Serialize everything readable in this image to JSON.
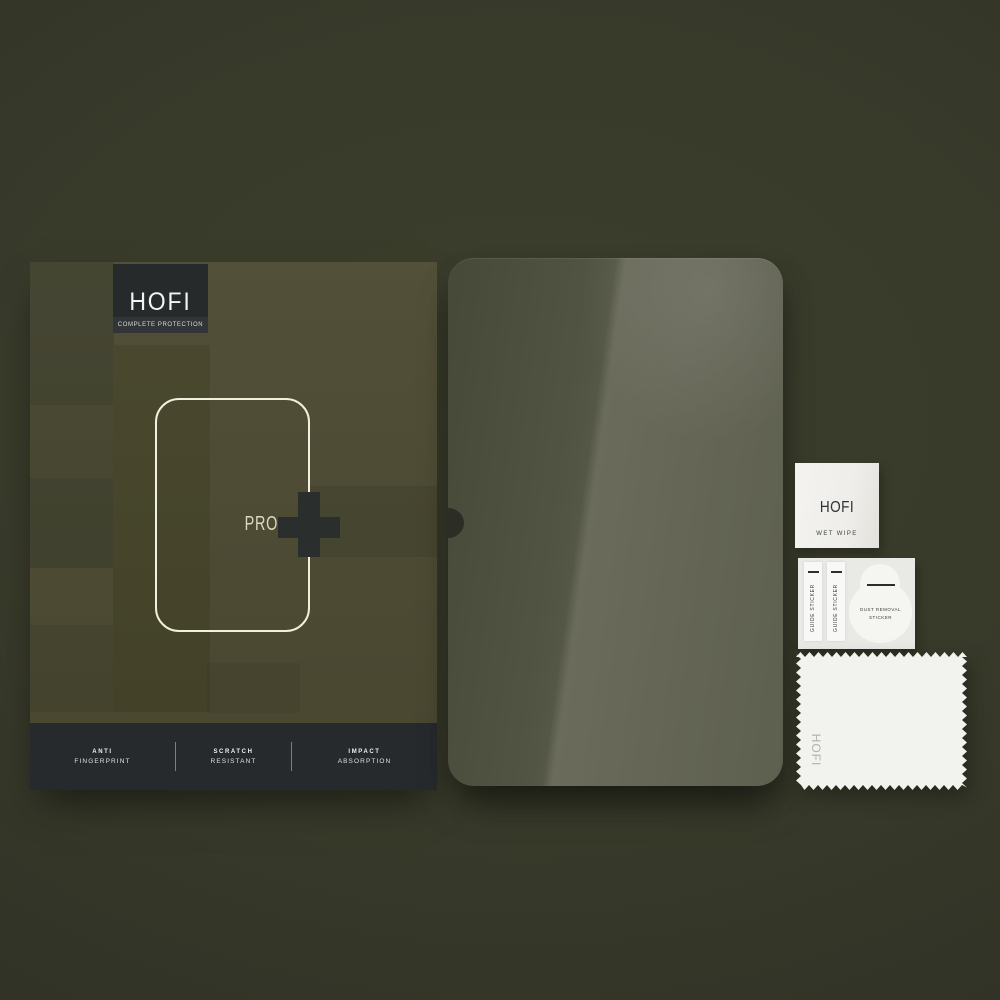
{
  "product": {
    "brand": "HOFI",
    "tagline": "COMPLETE PROTECTION",
    "model": "PRO",
    "model_suffix_icon": "plus-icon",
    "features": [
      {
        "line1": "ANTI",
        "line2": "FINGERPRINT"
      },
      {
        "line1": "SCRATCH",
        "line2": "RESISTANT"
      },
      {
        "line1": "IMPACT",
        "line2": "ABSORPTION"
      }
    ]
  },
  "accessories": {
    "wet_wipe": {
      "brand": "HOFI",
      "label": "WET WIPE"
    },
    "guide_stickers": [
      "GUIDE STICKER",
      "GUIDE STICKER"
    ],
    "dust_sticker": {
      "line1": "DUST REMOVAL",
      "line2": "STICKER"
    },
    "cloth": {
      "brand": "HOFI"
    }
  },
  "colors": {
    "background": "#383a2a",
    "box_olive": "#4c4a32",
    "box_pattern_dark": "#3f402c",
    "charcoal": "#262a2c",
    "outline_cream": "#f2efde",
    "glass_tint_dark": "#515343",
    "glass_tint_light": "#6a6b5b",
    "accessory_white": "#f2f2ee"
  }
}
